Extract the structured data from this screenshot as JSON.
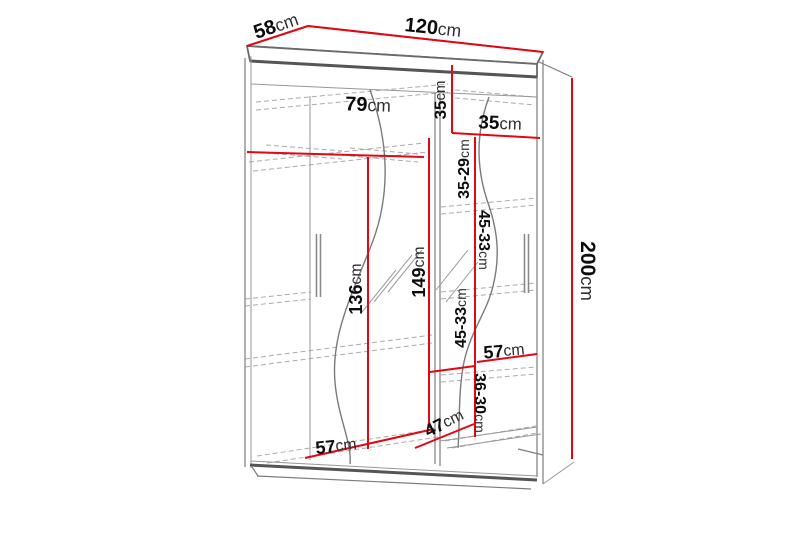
{
  "page": {
    "background_color": "#ffffff"
  },
  "diagram": {
    "type": "furniture-dimension-diagram",
    "subject": "two-door sliding wardrobe with interior measurements",
    "accent_color": "#e30613",
    "outline_color": "#6a6a6a",
    "dimensions": {
      "width": {
        "num": "120",
        "unit": "cm"
      },
      "depth": {
        "num": "58",
        "unit": "cm"
      },
      "height": {
        "num": "200",
        "unit": "cm"
      },
      "top_left_inner_width": {
        "num": "79",
        "unit": "cm"
      },
      "top_shelf_height": {
        "num": "35",
        "unit": "cm"
      },
      "top_right_width": {
        "num": "35",
        "unit": "cm"
      },
      "shelf_range_1": {
        "num": "35-29",
        "unit": "cm"
      },
      "shelf_range_2": {
        "num": "45-33",
        "unit": "cm"
      },
      "shelf_range_3": {
        "num": "45-33",
        "unit": "cm"
      },
      "shelf_range_4": {
        "num": "36-30",
        "unit": "cm"
      },
      "left_hanging_height": {
        "num": "136",
        "unit": "cm"
      },
      "middle_hanging_height": {
        "num": "149",
        "unit": "cm"
      },
      "right_shelf_width": {
        "num": "57",
        "unit": "cm"
      },
      "bottom_shelf_depth": {
        "num": "47",
        "unit": "cm"
      },
      "bottom_left_width": {
        "num": "57",
        "unit": "cm"
      }
    }
  }
}
